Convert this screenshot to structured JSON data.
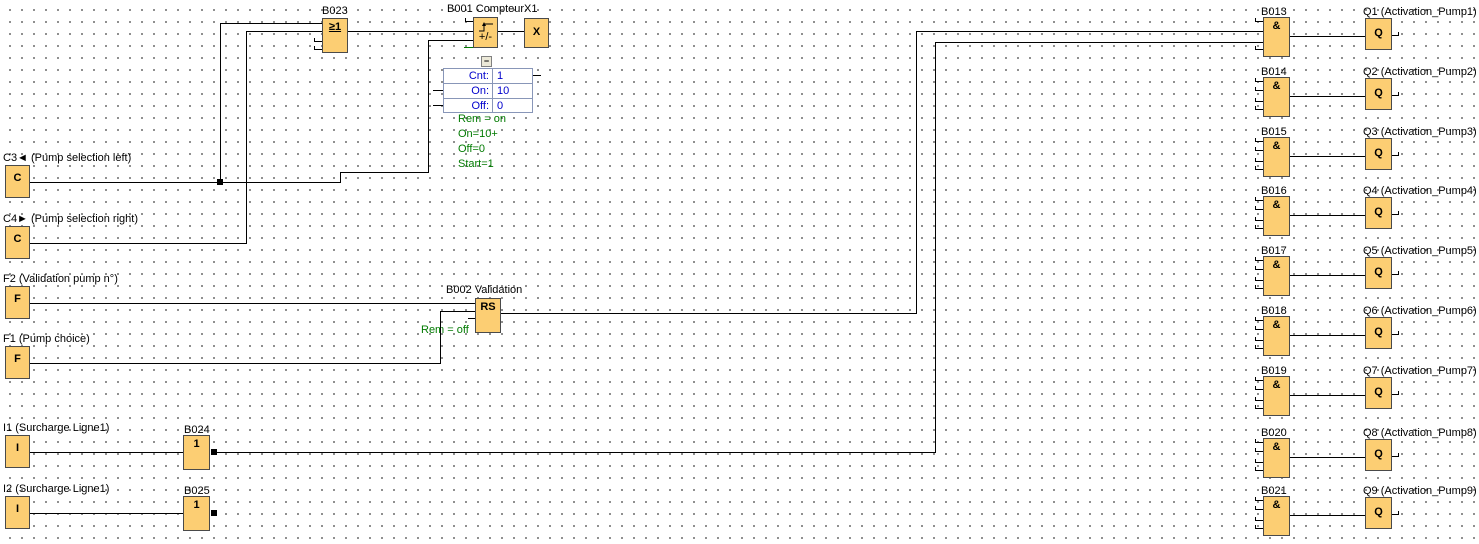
{
  "colors": {
    "block_fill": "#FCCE73",
    "wire": "#000000",
    "background": "#FFFFFF",
    "param_text": "#0000CC",
    "param_border": "#8896B8",
    "annotation_green": "#007A00"
  },
  "inputs": {
    "c3": {
      "label": "C3◄ (Pump selection left)",
      "letter": "C"
    },
    "c4": {
      "label": "C4► (Pump selection right)",
      "letter": "C"
    },
    "f2": {
      "label": "F2 (Validation pump n°)",
      "letter": "F"
    },
    "f1": {
      "label": "F1 (Pump choice)",
      "letter": "F"
    },
    "i1": {
      "label": "I1 (Surcharge Ligne1)",
      "letter": "I"
    },
    "i2": {
      "label": "I2 (Surcharge Ligne1)",
      "letter": "I"
    }
  },
  "or_gate": {
    "label": "B023",
    "symbol": "≥1"
  },
  "not_gate_1": {
    "label": "B024",
    "symbol": "1"
  },
  "not_gate_2": {
    "label": "B025",
    "symbol": "1"
  },
  "counter": {
    "label": "B001 Compteur",
    "symbol": "+/-",
    "connector_label": "X1",
    "connector_symbol": "X",
    "collapse": "−",
    "params": [
      {
        "name": "Cnt:",
        "value": "1"
      },
      {
        "name": "On:",
        "value": "10"
      },
      {
        "name": "Off:",
        "value": "0"
      }
    ],
    "annotations": [
      "Rem = on",
      "On=10+",
      "Off=0",
      "Start=1"
    ]
  },
  "rs_block": {
    "label": "B002 Validation",
    "symbol": "RS",
    "annotation": "Rem = off"
  },
  "and_symbol": "&",
  "q_symbol": "Q",
  "rows": [
    {
      "gate": "B013",
      "q": "Q1 (Activation_Pump1)"
    },
    {
      "gate": "B014",
      "q": "Q2 (Activation_Pump2)"
    },
    {
      "gate": "B015",
      "q": "Q3 (Activation_Pump3)"
    },
    {
      "gate": "B016",
      "q": "Q4 (Activation_Pump4)"
    },
    {
      "gate": "B017",
      "q": "Q5 (Activation_Pump5)"
    },
    {
      "gate": "B018",
      "q": "Q6 (Activation_Pump6)"
    },
    {
      "gate": "B019",
      "q": "Q7 (Activation_Pump7)"
    },
    {
      "gate": "B020",
      "q": "Q8 (Activation_Pump8)"
    },
    {
      "gate": "B021",
      "q": "Q9 (Activation_Pump9)"
    }
  ]
}
